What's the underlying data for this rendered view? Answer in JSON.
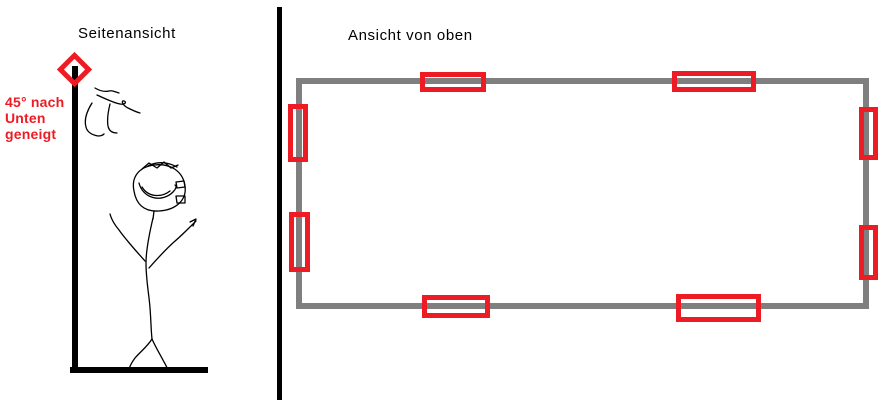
{
  "colors": {
    "red": "#ED1C24",
    "gray": "#7F7F7F",
    "ink": "#000000",
    "background": "#FFFFFF"
  },
  "side_view": {
    "title": "Seitenansicht",
    "annotation_lines": [
      "45° nach",
      "Unten",
      "geneigt"
    ]
  },
  "top_view": {
    "title": "Ansicht von oben",
    "markers": [
      {
        "wall": "top",
        "x": 420,
        "y": 72,
        "w": 66,
        "h": 20
      },
      {
        "wall": "top",
        "x": 672,
        "y": 71,
        "w": 84,
        "h": 21
      },
      {
        "wall": "right",
        "x": 859,
        "y": 107,
        "w": 19,
        "h": 53
      },
      {
        "wall": "right",
        "x": 859,
        "y": 225,
        "w": 19,
        "h": 55
      },
      {
        "wall": "bottom",
        "x": 422,
        "y": 295,
        "w": 68,
        "h": 23
      },
      {
        "wall": "bottom",
        "x": 676,
        "y": 294,
        "w": 85,
        "h": 28
      },
      {
        "wall": "left",
        "x": 288,
        "y": 104,
        "w": 20,
        "h": 58
      },
      {
        "wall": "left",
        "x": 289,
        "y": 212,
        "w": 21,
        "h": 60
      }
    ]
  }
}
